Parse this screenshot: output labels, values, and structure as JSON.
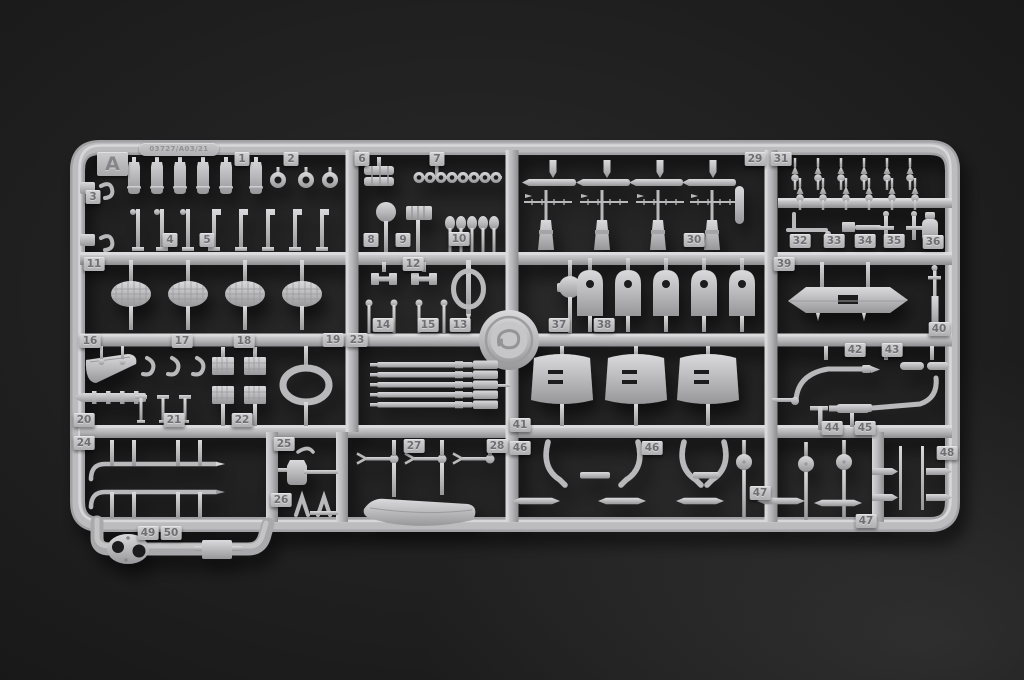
{
  "sprue": {
    "letter": "A",
    "mold_stamp": "03727/A03/21"
  },
  "colors": {
    "plastic": "#b8b8ba",
    "plastic_highlight": "#dddddf",
    "plastic_shadow": "#8e8e91",
    "background": "#1a1a1a",
    "tag_text": "#6f6f73"
  },
  "part_tags": [
    {
      "label": "1",
      "x": 242,
      "y": 159
    },
    {
      "label": "2",
      "x": 291,
      "y": 159
    },
    {
      "label": "6",
      "x": 362,
      "y": 159
    },
    {
      "label": "7",
      "x": 437,
      "y": 159
    },
    {
      "label": "29",
      "x": 755,
      "y": 159
    },
    {
      "label": "31",
      "x": 781,
      "y": 159
    },
    {
      "label": "3",
      "x": 93,
      "y": 197
    },
    {
      "label": "4",
      "x": 170,
      "y": 240
    },
    {
      "label": "5",
      "x": 207,
      "y": 240
    },
    {
      "label": "8",
      "x": 371,
      "y": 240
    },
    {
      "label": "9",
      "x": 403,
      "y": 240
    },
    {
      "label": "10",
      "x": 459,
      "y": 239
    },
    {
      "label": "30",
      "x": 694,
      "y": 240
    },
    {
      "label": "32",
      "x": 800,
      "y": 241
    },
    {
      "label": "33",
      "x": 834,
      "y": 241
    },
    {
      "label": "34",
      "x": 865,
      "y": 241
    },
    {
      "label": "35",
      "x": 894,
      "y": 241
    },
    {
      "label": "36",
      "x": 933,
      "y": 242
    },
    {
      "label": "11",
      "x": 94,
      "y": 264
    },
    {
      "label": "12",
      "x": 413,
      "y": 264
    },
    {
      "label": "39",
      "x": 784,
      "y": 264
    },
    {
      "label": "14",
      "x": 383,
      "y": 325
    },
    {
      "label": "15",
      "x": 428,
      "y": 325
    },
    {
      "label": "13",
      "x": 460,
      "y": 325
    },
    {
      "label": "37",
      "x": 559,
      "y": 325
    },
    {
      "label": "38",
      "x": 604,
      "y": 325
    },
    {
      "label": "40",
      "x": 939,
      "y": 329
    },
    {
      "label": "16",
      "x": 90,
      "y": 341
    },
    {
      "label": "17",
      "x": 182,
      "y": 341
    },
    {
      "label": "18",
      "x": 244,
      "y": 341
    },
    {
      "label": "19",
      "x": 333,
      "y": 340
    },
    {
      "label": "23",
      "x": 357,
      "y": 340
    },
    {
      "label": "42",
      "x": 855,
      "y": 350
    },
    {
      "label": "43",
      "x": 892,
      "y": 350
    },
    {
      "label": "20",
      "x": 84,
      "y": 420
    },
    {
      "label": "21",
      "x": 174,
      "y": 420
    },
    {
      "label": "22",
      "x": 242,
      "y": 420
    },
    {
      "label": "41",
      "x": 520,
      "y": 425
    },
    {
      "label": "44",
      "x": 832,
      "y": 428
    },
    {
      "label": "45",
      "x": 865,
      "y": 428
    },
    {
      "label": "24",
      "x": 84,
      "y": 443
    },
    {
      "label": "25",
      "x": 284,
      "y": 444
    },
    {
      "label": "27",
      "x": 414,
      "y": 446
    },
    {
      "label": "28",
      "x": 497,
      "y": 446
    },
    {
      "label": "46",
      "x": 520,
      "y": 448
    },
    {
      "label": "46",
      "x": 652,
      "y": 448
    },
    {
      "label": "48",
      "x": 947,
      "y": 453
    },
    {
      "label": "26",
      "x": 281,
      "y": 500
    },
    {
      "label": "47",
      "x": 760,
      "y": 493
    },
    {
      "label": "47",
      "x": 866,
      "y": 521
    },
    {
      "label": "49",
      "x": 148,
      "y": 533
    },
    {
      "label": "50",
      "x": 171,
      "y": 533
    }
  ]
}
